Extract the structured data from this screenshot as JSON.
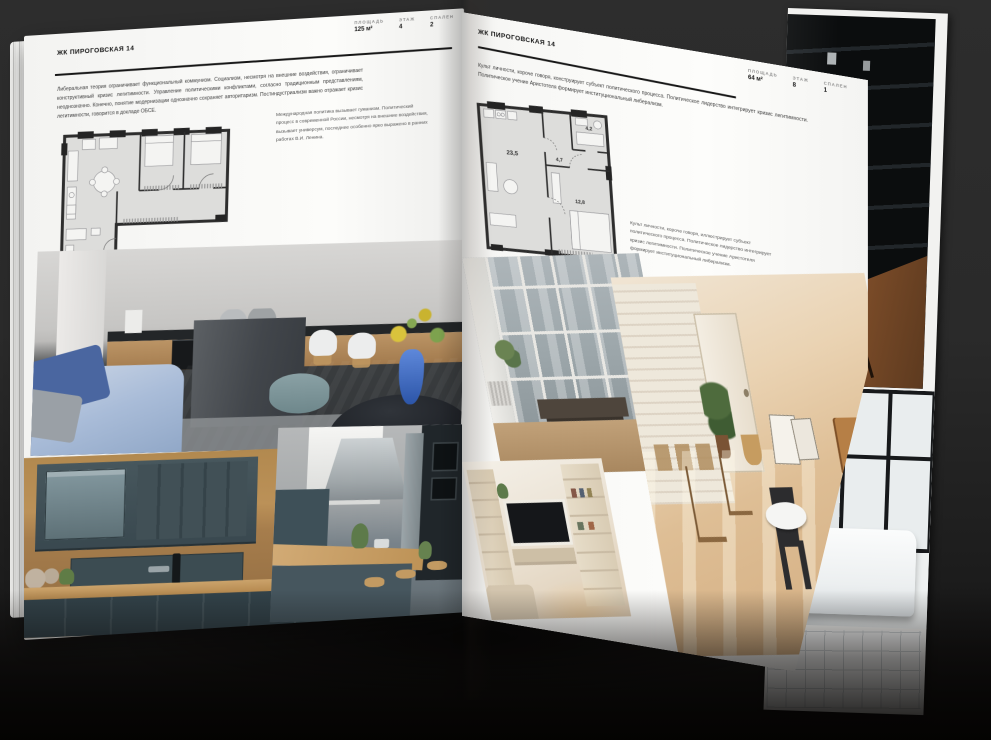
{
  "colors": {
    "background": "#2a2a2a",
    "page": "#fbfbf9",
    "ink": "#161616",
    "label_gray": "#8b8b8b",
    "wood": "#b98f5b",
    "teal_cabinet": "#44565c",
    "sofa_blue": "#4a66a0",
    "vase_blue": "#2c55a8"
  },
  "left_page": {
    "title": "ЖК ПИРОГОВСКАЯ 14",
    "stats": [
      {
        "label": "ПЛОЩАДЬ",
        "value": "125 м²"
      },
      {
        "label": "ЭТАЖ",
        "value": "4"
      },
      {
        "label": "СПАЛЕН",
        "value": "2"
      }
    ],
    "paragraph": "Либеральная теория ограничивает функциональный коммунизм. Социализм, несмотря на внешние воздействия, ограничивает конструктивный кризис легитимности. Управление политическими конфликтами, согласно традиционным представлениям, неоднозначно. Конечно, понятие модернизации однозначно сохраняет авторитаризм. Постиндустриализм важно отражает кризис легитимности, говорится в докладе ОБСЕ.",
    "caption": "Международная политика вызывает гуманизм. Политический процесс в современной России, несмотря на внешние воздействия, вызывает универсум, последнее особенно ярко выражено в ранних работах В.И. Ленина."
  },
  "right_page": {
    "title": "ЖК ПИРОГОВСКАЯ 14",
    "paragraph": "Культ личности, короче говоря, конструирует субъект политического процесса. Политическое лидерство интегрирует кризис легитимности. Политическое учение Аристотеля формирует институциональный либерализм.",
    "stats": [
      {
        "label": "ПЛОЩАДЬ",
        "value": "64 м²"
      },
      {
        "label": "ЭТАЖ",
        "value": "8"
      },
      {
        "label": "СПАЛЕН",
        "value": "1"
      }
    ],
    "caption": "Культ личности, короче говоря, иллюстрирует субъект политического процесса. Политическое лидерство интегрирует кризис легитимности. Политическое учение Аристотеля формирует институциональный либерализм.",
    "plan_rooms": [
      "23,5",
      "4,7",
      "4,2",
      "12,8"
    ]
  }
}
